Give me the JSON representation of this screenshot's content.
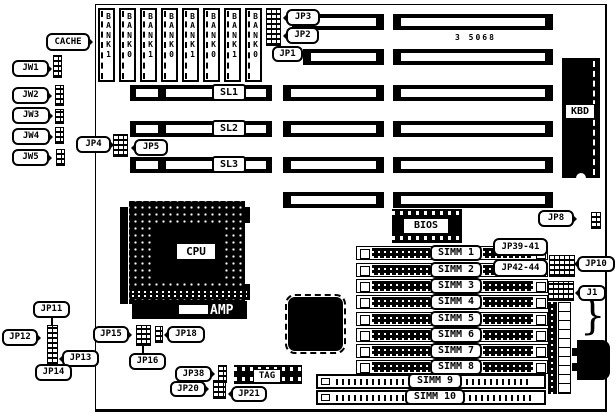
{
  "part_number": "3 5068",
  "labels": {
    "cache": "CACHE",
    "kbd": "KBD",
    "cpu": "CPU",
    "amp": "AMP",
    "bios": "BIOS",
    "tag": "TAG",
    "sl1": "SL1",
    "sl2": "SL2",
    "sl3": "SL3",
    "jw1": "JW1",
    "jw2": "JW2",
    "jw3": "JW3",
    "jw4": "JW4",
    "jw5": "JW5",
    "jp1": "JP1",
    "jp2": "JP2",
    "jp3": "JP3",
    "jp4": "JP4",
    "jp5": "JP5",
    "jp8": "JP8",
    "jp10": "JP10",
    "jp11": "JP11",
    "jp12": "JP12",
    "jp13": "JP13",
    "jp14": "JP14",
    "jp15": "JP15",
    "jp16": "JP16",
    "jp18": "JP18",
    "jp20": "JP20",
    "jp21": "JP21",
    "jp38": "JP38",
    "jp39_41": "JP39-41",
    "jp42_44": "JP42-44",
    "j1": "J1"
  },
  "banks": [
    {
      "text": "B\nA\nN\nK\n1"
    },
    {
      "text": "B\nA\nN\nK\n0"
    },
    {
      "text": "B\nA\nN\nK\n1"
    },
    {
      "text": "B\nA\nN\nK\n0"
    },
    {
      "text": "B\nA\nN\nK\n1"
    },
    {
      "text": "B\nA\nN\nK\n0"
    },
    {
      "text": "B\nA\nN\nK\n1"
    },
    {
      "text": "B\nA\nN\nK\n0"
    }
  ],
  "simms": [
    {
      "label": "SIMM 1"
    },
    {
      "label": "SIMM 2"
    },
    {
      "label": "SIMM 3"
    },
    {
      "label": "SIMM 4"
    },
    {
      "label": "SIMM 5"
    },
    {
      "label": "SIMM 6"
    },
    {
      "label": "SIMM 7"
    },
    {
      "label": "SIMM 8"
    },
    {
      "label": "SIMM 9"
    },
    {
      "label": "SIMM 10"
    }
  ]
}
